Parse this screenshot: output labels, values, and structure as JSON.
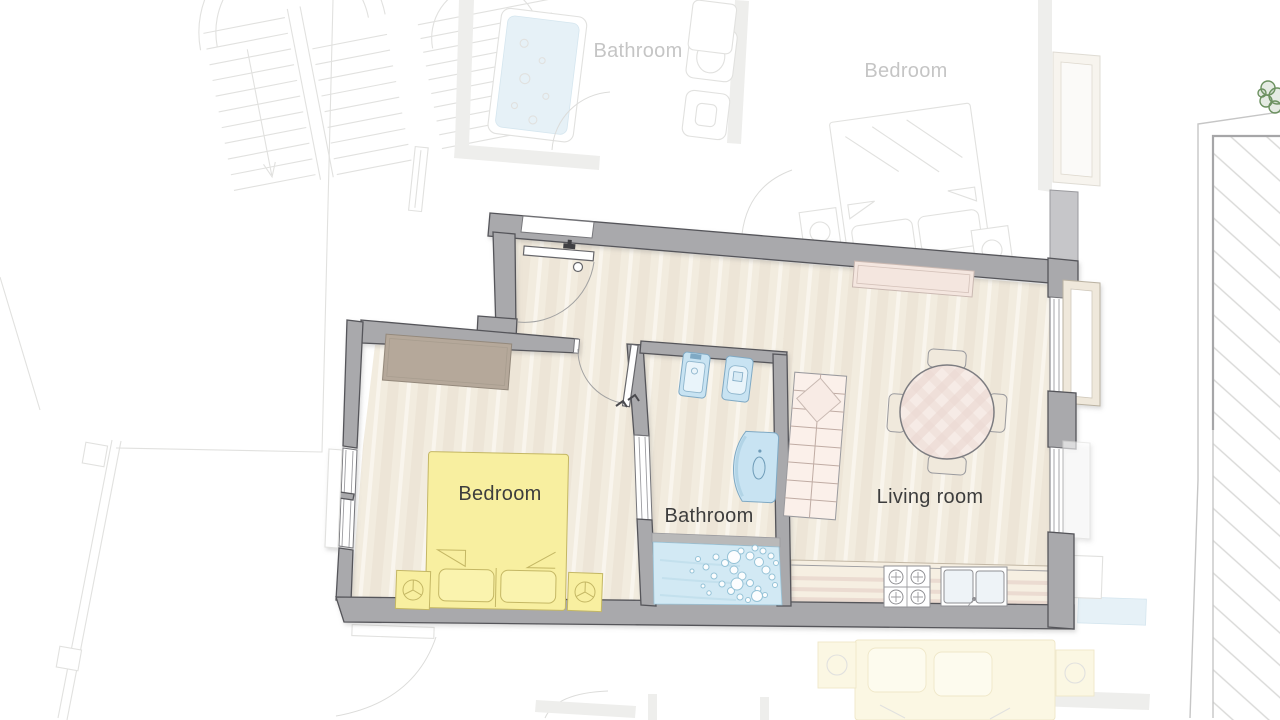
{
  "title": "Apartment floor plan",
  "apartment": {
    "rooms": [
      {
        "id": "bedroom",
        "label": "Bedroom"
      },
      {
        "id": "bathroom",
        "label": "Bathroom"
      },
      {
        "id": "living_room",
        "label": "Living room"
      }
    ]
  },
  "adjacent_units": {
    "rooms": [
      {
        "id": "bathroom_upper",
        "label": "Bathroom"
      },
      {
        "id": "bedroom_upper",
        "label": "Bedroom"
      }
    ]
  },
  "colors": {
    "wall_gray": "#a9a9ac",
    "wall_outline": "#55555a",
    "floor_base": "#f2ecdf",
    "floor_stripe": "#e9e0cf",
    "bed_yellow": "#f8efa0",
    "bed_outline": "#c4b764",
    "pillow_yellow": "#faf3ae",
    "wardrobe_taupe": "#b5a89a",
    "wardrobe_outline": "#93887b",
    "water_blue": "#d2e9f4",
    "water_outline": "#99c4d9",
    "fixture_blue": "#c8e3f2",
    "fixture_outline": "#7fa9c4",
    "pink_beige": "#f4e6df",
    "pink_line": "#dfc8bf",
    "counter_beige": "#f6efe2",
    "chair_beige": "#f0e9dc",
    "label_dark": "#3d3d3d",
    "label_faded": "#c5c5c5",
    "ghost_line": "#e1e1df",
    "ghost_fill": "#eeeeec",
    "ghost_blue": "#e6f1f7",
    "ghost_yellow": "#fbf7e3",
    "terrace_line": "#c6c6c6",
    "hatch_line": "#d9d9d7",
    "tree_green": "#6c9160",
    "door_arc": "#a2a2a2"
  }
}
